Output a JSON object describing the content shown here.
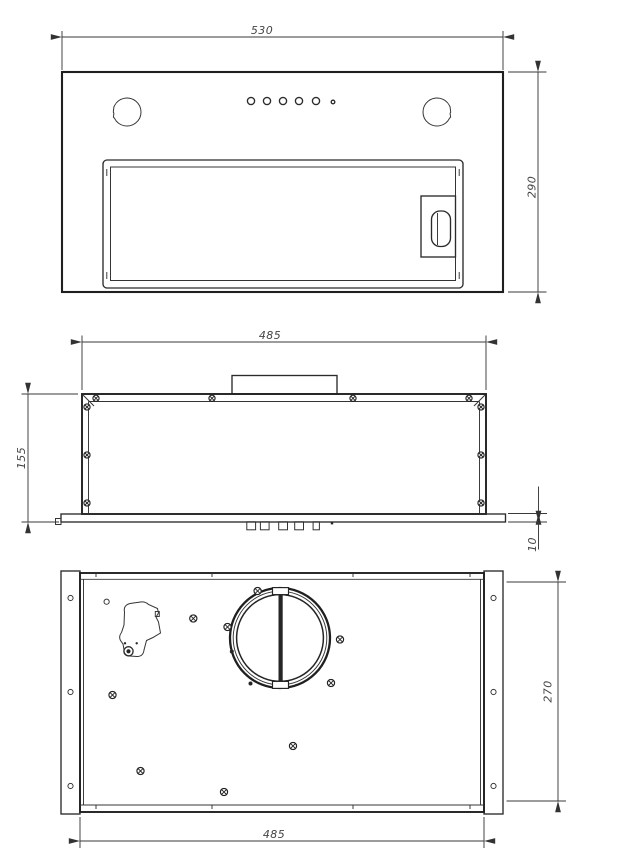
{
  "page": {
    "background_color": "#ffffff",
    "line_color": "#2b2b2b",
    "dimension_text_color": "#454545"
  },
  "drawing": {
    "type": "technical-orthographic-drawing",
    "subject": "built-in-cooker-hood",
    "dimensions": {
      "front_width": "530",
      "front_height": "290",
      "body_width_top": "485",
      "body_height": "155",
      "flange_thickness": "10",
      "body_depth": "270",
      "body_width_bottom": "485"
    },
    "views": [
      {
        "id": "front-view",
        "position": "top",
        "features": [
          "lamp-cutout-left",
          "lamp-cutout-right",
          "control-buttons-5-round-plus-1-indicator",
          "grease-filter-panel",
          "filter-latch-handle"
        ]
      },
      {
        "id": "side-view",
        "position": "middle",
        "features": [
          "duct-connector",
          "housing-profile",
          "mounting-flange",
          "corner-screws-10",
          "push-buttons-profile-5"
        ]
      },
      {
        "id": "bottom-view",
        "position": "bottom",
        "features": [
          "mounting-strip-left-3-holes",
          "mounting-strip-right-3-holes",
          "air-outlet-ring-with-damper",
          "cable-clamp-bracket",
          "sheet-screws-9"
        ]
      }
    ]
  }
}
